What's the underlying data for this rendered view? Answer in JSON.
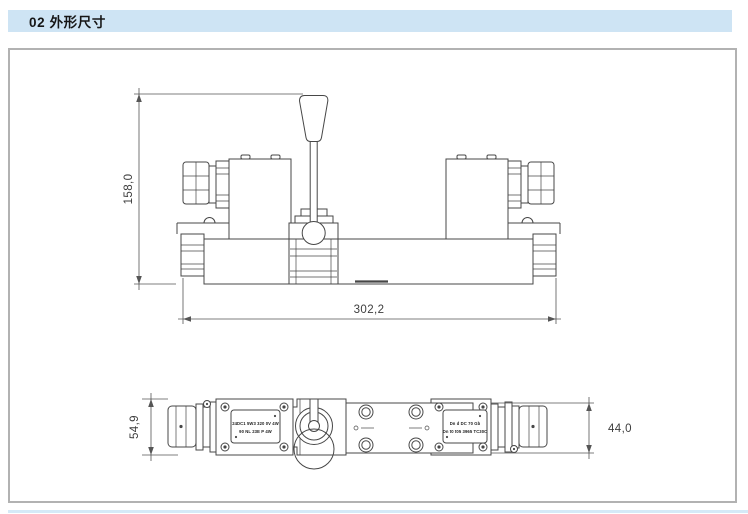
{
  "page": {
    "header": {
      "title": "02 外形尺寸"
    },
    "colors": {
      "header_bg": "#cee4f4",
      "header_text": "#161616",
      "panel_border": "#b2b2b2",
      "line": "#474747",
      "dim": "#555555",
      "footer_strip": "#d5e9f7"
    }
  },
  "drawing": {
    "front_view": {
      "height_dim": "158,0",
      "width_dim": "302,2"
    },
    "top_view": {
      "left_height_dim": "54,9",
      "right_height_dim": "44,0",
      "left_nameplate": {
        "line1": "24DC1 5W3 320 0V 4W",
        "line2": "90 NL 23E P 4W"
      },
      "right_nameplate": {
        "line1": "Dn d DC 70 Gb",
        "line2": "Dn t0 t05 3965 TC30C"
      }
    }
  }
}
